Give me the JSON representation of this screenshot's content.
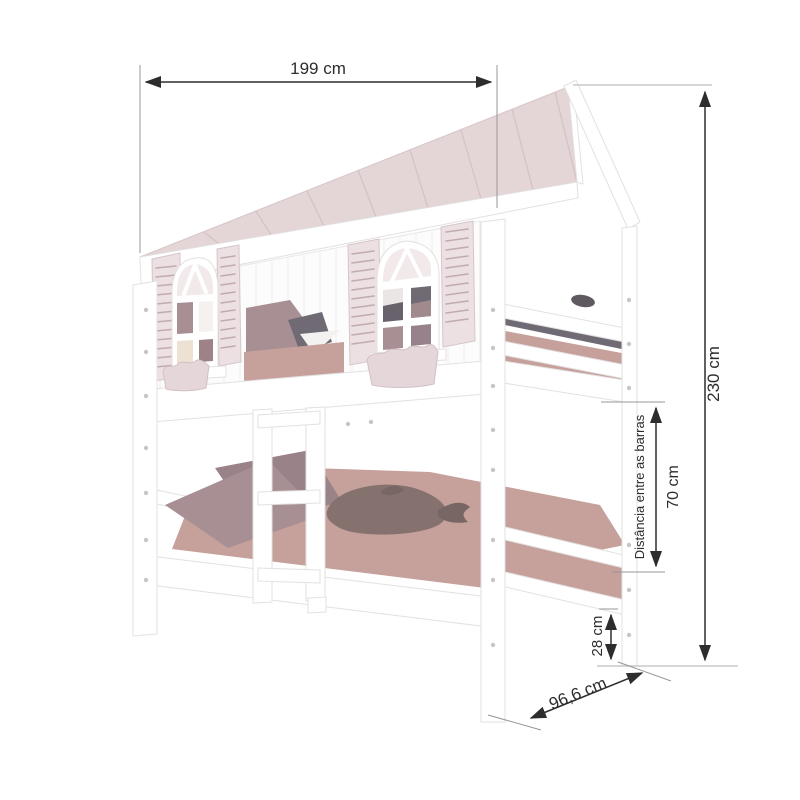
{
  "diagram": {
    "kind": "furniture-dimension-diagram",
    "dimensions": {
      "width_label": "199 cm",
      "height_label": "230 cm",
      "bar_distance_caption": "Distância entre as barras",
      "bar_distance_label": "70 cm",
      "foot_clearance_label": "28 cm",
      "depth_label": "96,6 cm"
    }
  },
  "colors": {
    "roof": "#e4d5d7",
    "roof_seam": "#d4c3c6",
    "shutter": "#ece0e2",
    "shutter_slat": "#c2abaf",
    "planter": "#e5d6d9",
    "wall": "#fdfcfc",
    "wood_white": "#ffffff",
    "mattress": "#c6a09a",
    "pillow_front": "#a78f94",
    "pillow_back": "#998288",
    "pillow_dark": "#6f6a74",
    "pillow_cream": "#ece1d2",
    "pane_light": "#f1e9ea",
    "plush": "#85726e",
    "plush_dark": "#776663",
    "dim_line": "#2d2d2d",
    "ext_line": "#979797",
    "guide_line": "#c9c9c9",
    "text": "#2d2d2d"
  }
}
